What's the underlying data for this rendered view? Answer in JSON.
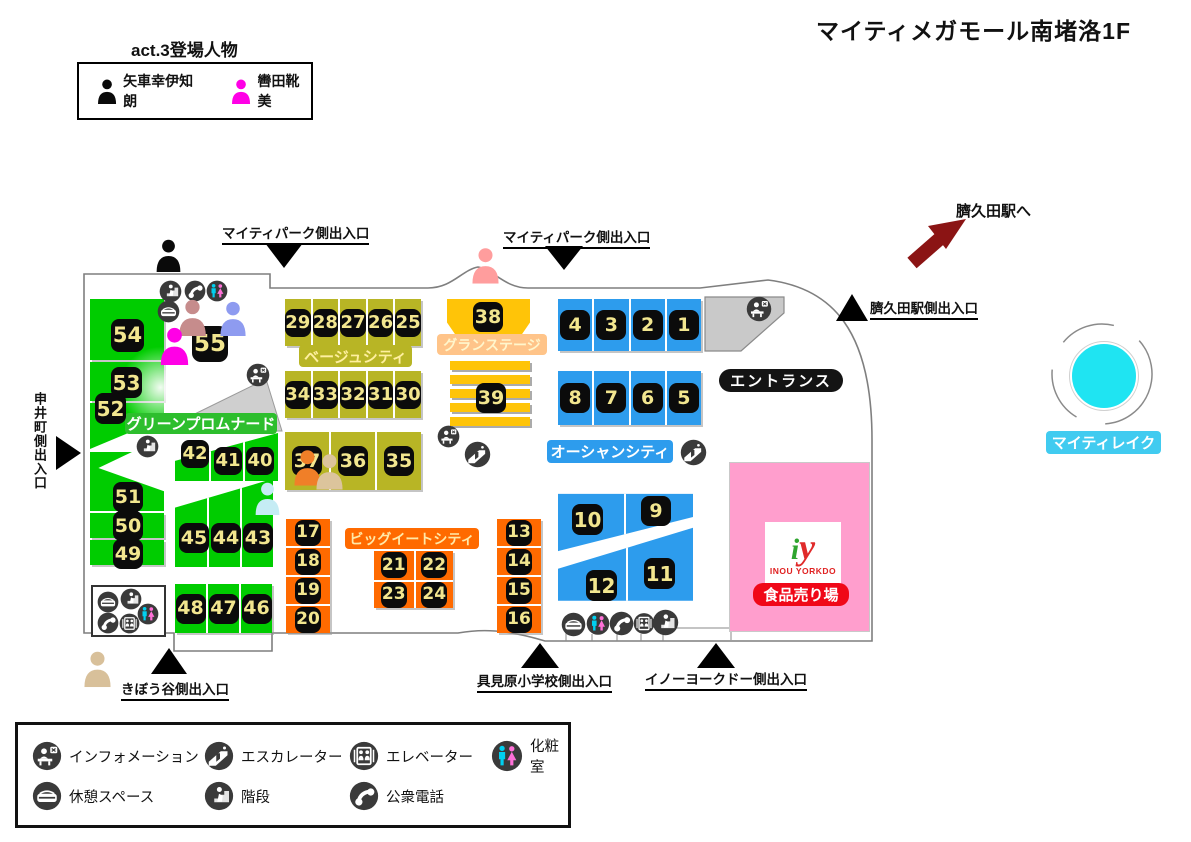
{
  "title": "マイティメガモール南堵洛1F",
  "cast": {
    "title": "act.3登場人物",
    "characters": [
      {
        "name": "矢車幸伊知朗",
        "color": "#0A0A0A"
      },
      {
        "name": "轡田靴美",
        "color": "#FF00E6"
      }
    ]
  },
  "station": {
    "label": "臍久田駅へ",
    "arrow_color": "#8B1414"
  },
  "exits": {
    "park_west": "マイティパーク側出入口",
    "park_east": "マイティパーク側出入口",
    "station_side": "臍久田駅側出入口",
    "monoi_town": "申井町側出入口",
    "kibou_valley": "きぼう谷側出入口",
    "gumihara_school": "具見原小学校側出入口",
    "inou_yorkdo_side": "イノーヨークドー側出入口"
  },
  "zones": {
    "green": {
      "label": "グリーンプロムナード",
      "color": "#00CC00",
      "stores": [
        "54",
        "53",
        "52",
        "51",
        "50",
        "49",
        "42",
        "41",
        "40",
        "45",
        "44",
        "43",
        "48",
        "47",
        "46",
        "55"
      ]
    },
    "beige": {
      "label": "ベージュシティ",
      "color": "#B8B525",
      "stores": [
        "29",
        "28",
        "27",
        "26",
        "25",
        "34",
        "33",
        "32",
        "31",
        "30",
        "37",
        "36",
        "35"
      ]
    },
    "stage": {
      "label": "グランステージ",
      "color": "#FFC408",
      "stores": [
        "38",
        "39"
      ]
    },
    "ocean": {
      "label": "オーシャンシティ",
      "color": "#2D9CED",
      "stores": [
        "4",
        "3",
        "2",
        "1",
        "8",
        "7",
        "6",
        "5",
        "10",
        "9",
        "12",
        "11"
      ]
    },
    "bigeat": {
      "label": "ビッグイートシティ",
      "color": "#FF6A00",
      "stores": [
        "17",
        "18",
        "19",
        "20",
        "13",
        "14",
        "15",
        "16",
        "21",
        "22",
        "23",
        "24"
      ]
    }
  },
  "entrance": {
    "label": "エントランス"
  },
  "inou": {
    "logo_i": "i",
    "logo_y": "y",
    "name": "INOU YORKDO",
    "dept": "食品売り場"
  },
  "lake": {
    "label": "マイティレイク",
    "color": "#1FE4F2"
  },
  "legend": {
    "items": [
      {
        "icon": "information-icon",
        "label": "インフォメーション"
      },
      {
        "icon": "escalator-icon",
        "label": "エスカレーター"
      },
      {
        "icon": "elevator-icon",
        "label": "エレベーター"
      },
      {
        "icon": "restroom-icon",
        "label": "化粧室"
      },
      {
        "icon": "rest-space-icon",
        "label": "休憩スペース"
      },
      {
        "icon": "stairs-icon",
        "label": "階段"
      },
      {
        "icon": "public-phone-icon",
        "label": "公衆電話"
      }
    ]
  },
  "map_markers": {
    "person_colors": [
      "#0A0A0A",
      "#C68C8C",
      "#8E9BF0",
      "#FF00E6",
      "#FF9D9D",
      "#C5ECF4",
      "#F07F28",
      "#DCC49C",
      "#D8C09A"
    ]
  }
}
